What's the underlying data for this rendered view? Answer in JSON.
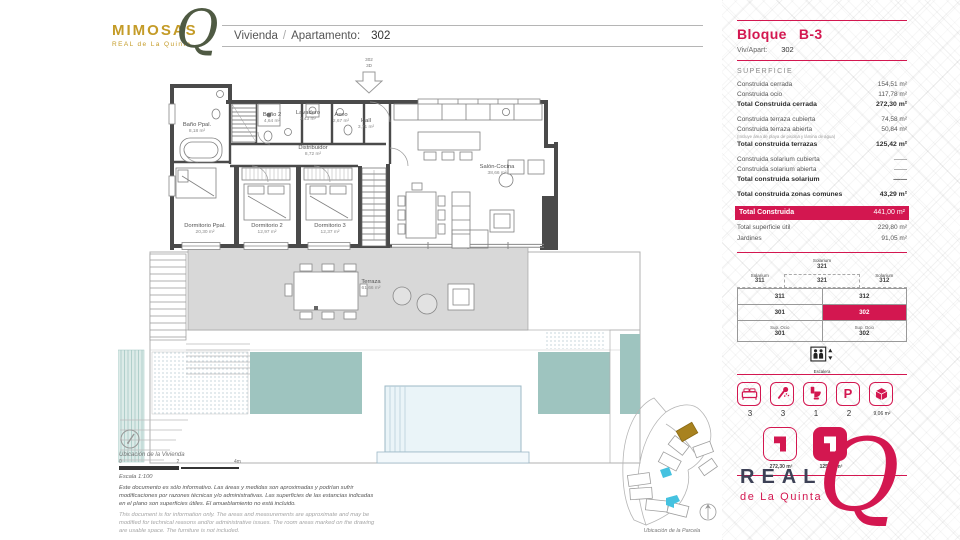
{
  "colors": {
    "accent": "#d31750",
    "gold": "#c49b27",
    "olive": "#4f5a43",
    "navy": "#3d4156",
    "teal": "#9ec4bf",
    "wall": "#4a4a4a"
  },
  "logo": {
    "name": "MIMOSAS",
    "sub": "REAL de La Quinta",
    "q": "Q"
  },
  "header": {
    "w1": "Vivienda",
    "sep": "/",
    "w2": "Apartamento:",
    "number": "302"
  },
  "plan": {
    "entry": {
      "line1": "302",
      "line2": "3D"
    },
    "rooms": {
      "bano_ppal": {
        "name": "Baño Ppal.",
        "area": "8,18 m²"
      },
      "bano2": {
        "name": "Baño 2",
        "area": "4,64 m²"
      },
      "lavadero": {
        "name": "Lavadero",
        "area": "3,43 m²"
      },
      "aseo": {
        "name": "Aseo",
        "area": "2,67 m²"
      },
      "hall": {
        "name": "Hall",
        "area": "3,71 m²"
      },
      "distribuidor": {
        "name": "Distribuidor",
        "area": "8,72 m²"
      },
      "dormitorio_ppal": {
        "name": "Dormitorio Ppal.",
        "area": "20,30 m²"
      },
      "dormitorio2": {
        "name": "Dormitorio 2",
        "area": "12,97 m²"
      },
      "dormitorio3": {
        "name": "Dormitorio 3",
        "area": "12,37 m²"
      },
      "salon": {
        "name": "Salón-Cocina",
        "area": "38,66 m²"
      },
      "terraza": {
        "name": "Terraza",
        "area": "61,66 m²"
      }
    }
  },
  "footer": {
    "ubicacion_vivienda": "Ubicación de la Vivienda",
    "scale0": "0",
    "scale2": "2",
    "scale4": "4m",
    "escala": "Escala 1:100",
    "disclaimer_es": "Este documento es sólo informativo. Las áreas y medidas son aproximadas y podrían sufrir modificaciones por razones técnicas y/o administrativas. Las superficies de las estancias indicadas en el plano son superficies útiles. El amueblamiento no está incluido.",
    "disclaimer_en": "This document is for information only. The areas and measurements are approximate and may be modified for technical reasons and/or administrative issues. The room areas marked on the drawing are usable space. The furniture is not included.",
    "ubicacion_parcela": "Ubicación de la Parcela"
  },
  "panel": {
    "bloque_label": "Bloque",
    "bloque_value": "B-3",
    "viv_label": "Viv/Apart:",
    "viv_value": "302",
    "superficie_title": "SUPERFICIE",
    "rows": [
      {
        "label": "Construida cerrada",
        "value": "154,51 m²"
      },
      {
        "label": "Construida ocio",
        "value": "117,78 m²"
      },
      {
        "label": "Total Construida cerrada",
        "value": "272,30 m²"
      },
      {
        "label": "Construida terraza cubierta",
        "value": "74,58 m²"
      },
      {
        "label": "Construida terraza abierta",
        "value": "50,84 m²"
      },
      {
        "label": "Total construida terrazas",
        "value": "125,42 m²"
      },
      {
        "label": "Construida solarium cubierta",
        "value": "——"
      },
      {
        "label": "Construida solarium abierta",
        "value": "——"
      },
      {
        "label": "Total construida solarium",
        "value": "——"
      },
      {
        "label": "Total construida zonas comunes",
        "value": "43,29 m²"
      },
      {
        "label": "Total superficie útil",
        "value": "229,80 m²"
      },
      {
        "label": "Jardines",
        "value": "91,05 m²"
      }
    ],
    "note": "(Incluye área de playa de piscina y lámina de agua)",
    "total_label": "Total Construida",
    "total_value": "441,00 m²",
    "diagram": {
      "top_word": "Solarium",
      "top_num": "321",
      "left_word": "Solarium",
      "left_num": "311",
      "mid": "321",
      "right_word": "Solarium",
      "right_num": "312",
      "r1c1": "311",
      "r1c2": "312",
      "r2c1": "301",
      "r2c2": "302",
      "r3w1": "Sup. Ocio",
      "r3n1": "301",
      "r3w2": "Sup. Ocio",
      "r3n2": "302",
      "lift": "Escalera"
    },
    "amenities": [
      {
        "icon": "bed",
        "value": "3"
      },
      {
        "icon": "shower",
        "value": "3"
      },
      {
        "icon": "wc",
        "value": "1"
      },
      {
        "icon": "parking",
        "value": "2"
      },
      {
        "icon": "storage",
        "value": "9,06 m²"
      }
    ],
    "plan_icons": [
      {
        "label": "272,30 m²"
      },
      {
        "label": "125,42 m²"
      }
    ]
  },
  "brand": {
    "real": "REAL",
    "sub": "de La Quinta",
    "q": "Q"
  }
}
